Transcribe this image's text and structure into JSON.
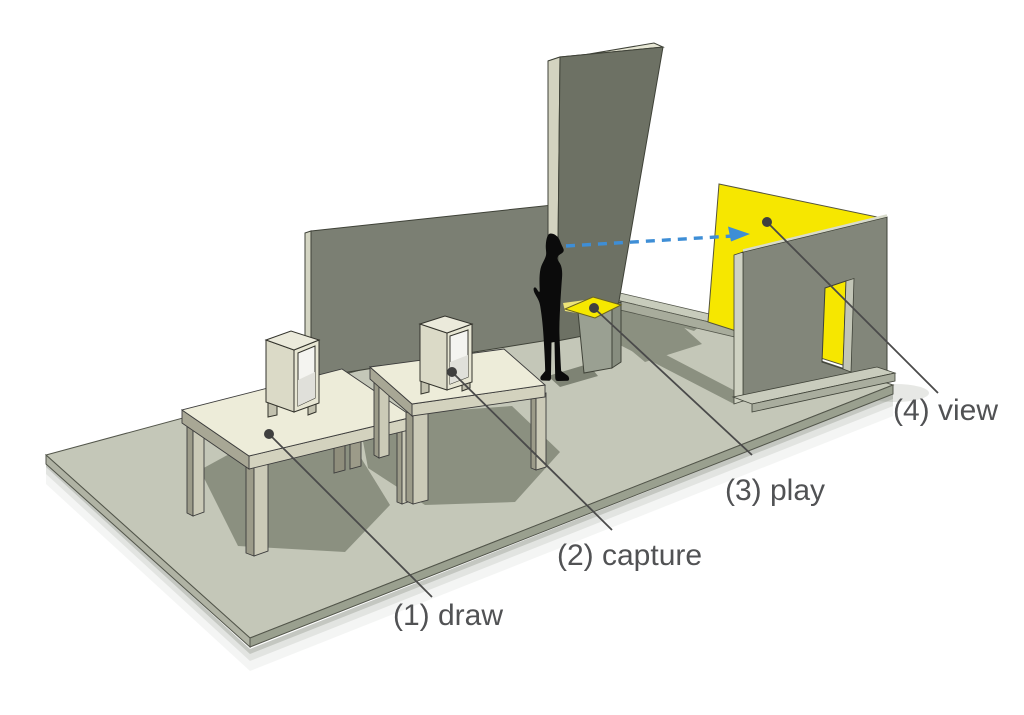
{
  "diagram": {
    "description": "Isometric 3D diagram of a four-station interactive installation on a platform",
    "background_color": "#ffffff",
    "stations": [
      {
        "number": "1",
        "name": "draw",
        "label": "(1) draw"
      },
      {
        "number": "2",
        "name": "capture",
        "label": "(2) capture"
      },
      {
        "number": "3",
        "name": "play",
        "label": "(3) play"
      },
      {
        "number": "4",
        "name": "view",
        "label": "(4) view"
      }
    ],
    "gaze_arrow": {
      "style": "dashed",
      "color": "#3e8ed6",
      "description": "sightline from visitor head to projection screen"
    },
    "palette": {
      "ground": "#c4c7b8",
      "ground_shadow": "#8b9080",
      "back_wall": "#7b7f73",
      "monolith": "#6d7164",
      "table_top": "#edecd9",
      "table_side": "#a8a795",
      "highlight_yellow": "#f6e800",
      "silhouette_black": "#0b0b0b",
      "right_wall": "#82867a",
      "label_text": "#515254",
      "leader_line": "#4a4a4a"
    }
  }
}
